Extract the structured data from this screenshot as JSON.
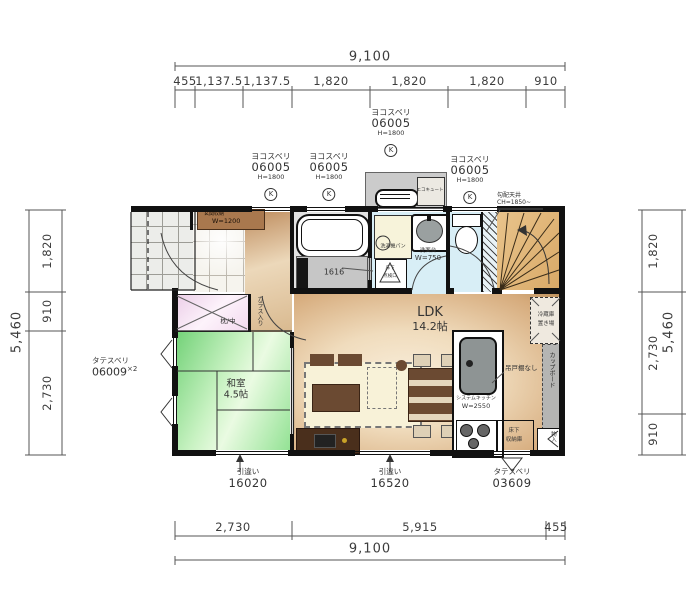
{
  "drawing": {
    "type": "floor-plan-1F"
  },
  "dims": {
    "top": {
      "overall": "9,100",
      "segments": [
        "455",
        "1,137.5",
        "1,137.5",
        "1,820",
        "1,820",
        "1,820",
        "910"
      ]
    },
    "bottom": {
      "overall": "9,100",
      "segments": [
        "2,730",
        "5,915",
        "455"
      ]
    },
    "left": {
      "overall": "5,460",
      "segments": [
        "1,820",
        "910",
        "2,730"
      ]
    },
    "right": {
      "overall": "5,460",
      "segments": [
        "1,820",
        "2,730",
        "910"
      ]
    }
  },
  "windows": {
    "top": [
      {
        "type": "ヨコスベリ",
        "code": "06005",
        "height": "H=1800",
        "mark": "K"
      },
      {
        "type": "ヨコスベリ",
        "code": "06005",
        "height": "H=1800",
        "mark": "K"
      },
      {
        "type": "ヨコスベリ",
        "code": "06005",
        "height": "H=1800",
        "mark": "K"
      },
      {
        "type": "ヨコスベリ",
        "code": "06005",
        "height": "H=1800",
        "mark": "K"
      }
    ],
    "left": {
      "type": "タテスベリ",
      "code": "06009",
      "mult": "×2"
    },
    "bottom": [
      {
        "type": "引違い",
        "code": "16020"
      },
      {
        "type": "引違い",
        "code": "16520"
      },
      {
        "type": "タテスベリ",
        "code": "03609"
      }
    ]
  },
  "rooms": {
    "ldk": {
      "name": "LDK",
      "size": "14.2帖"
    },
    "washitsu": {
      "name": "和室",
      "size": "4.5帖"
    },
    "closet_label": "枕/中",
    "hall_door_note": "ガラス入り"
  },
  "fixtures": {
    "entrance_storage": {
      "name": "玄関収納",
      "size": "W=1200"
    },
    "bath_unit": "1616",
    "washer_pan": "洗濯機パン",
    "vanity": {
      "name": "洗面台",
      "size": "W=750"
    },
    "floor_hatch": {
      "line1": "床下",
      "line2": "点検口"
    },
    "kitchen": {
      "name": "システムキッチン",
      "size": "W=2550"
    },
    "hanging_note": "吊戸棚なし",
    "underfloor_storage": {
      "line1": "床下",
      "line2": "収納庫"
    },
    "fridge_space": {
      "line1": "冷蔵庫",
      "line2": "置き場"
    },
    "cupboard": "カップボード",
    "small_closet": "物入",
    "ecocute": "エコキュート",
    "ceiling_note": {
      "line1": "勾配天井",
      "line2": "CH=1850~"
    }
  },
  "colors": {
    "wall": "#111111",
    "tatami_green": "#8ee08f",
    "wood_floor": "#e0c096",
    "water_blue": "#d8eef6",
    "closet_pink": "#f4dff2",
    "stairs_tan": "#e5bc82",
    "dim_text": "#3c3c3c"
  }
}
